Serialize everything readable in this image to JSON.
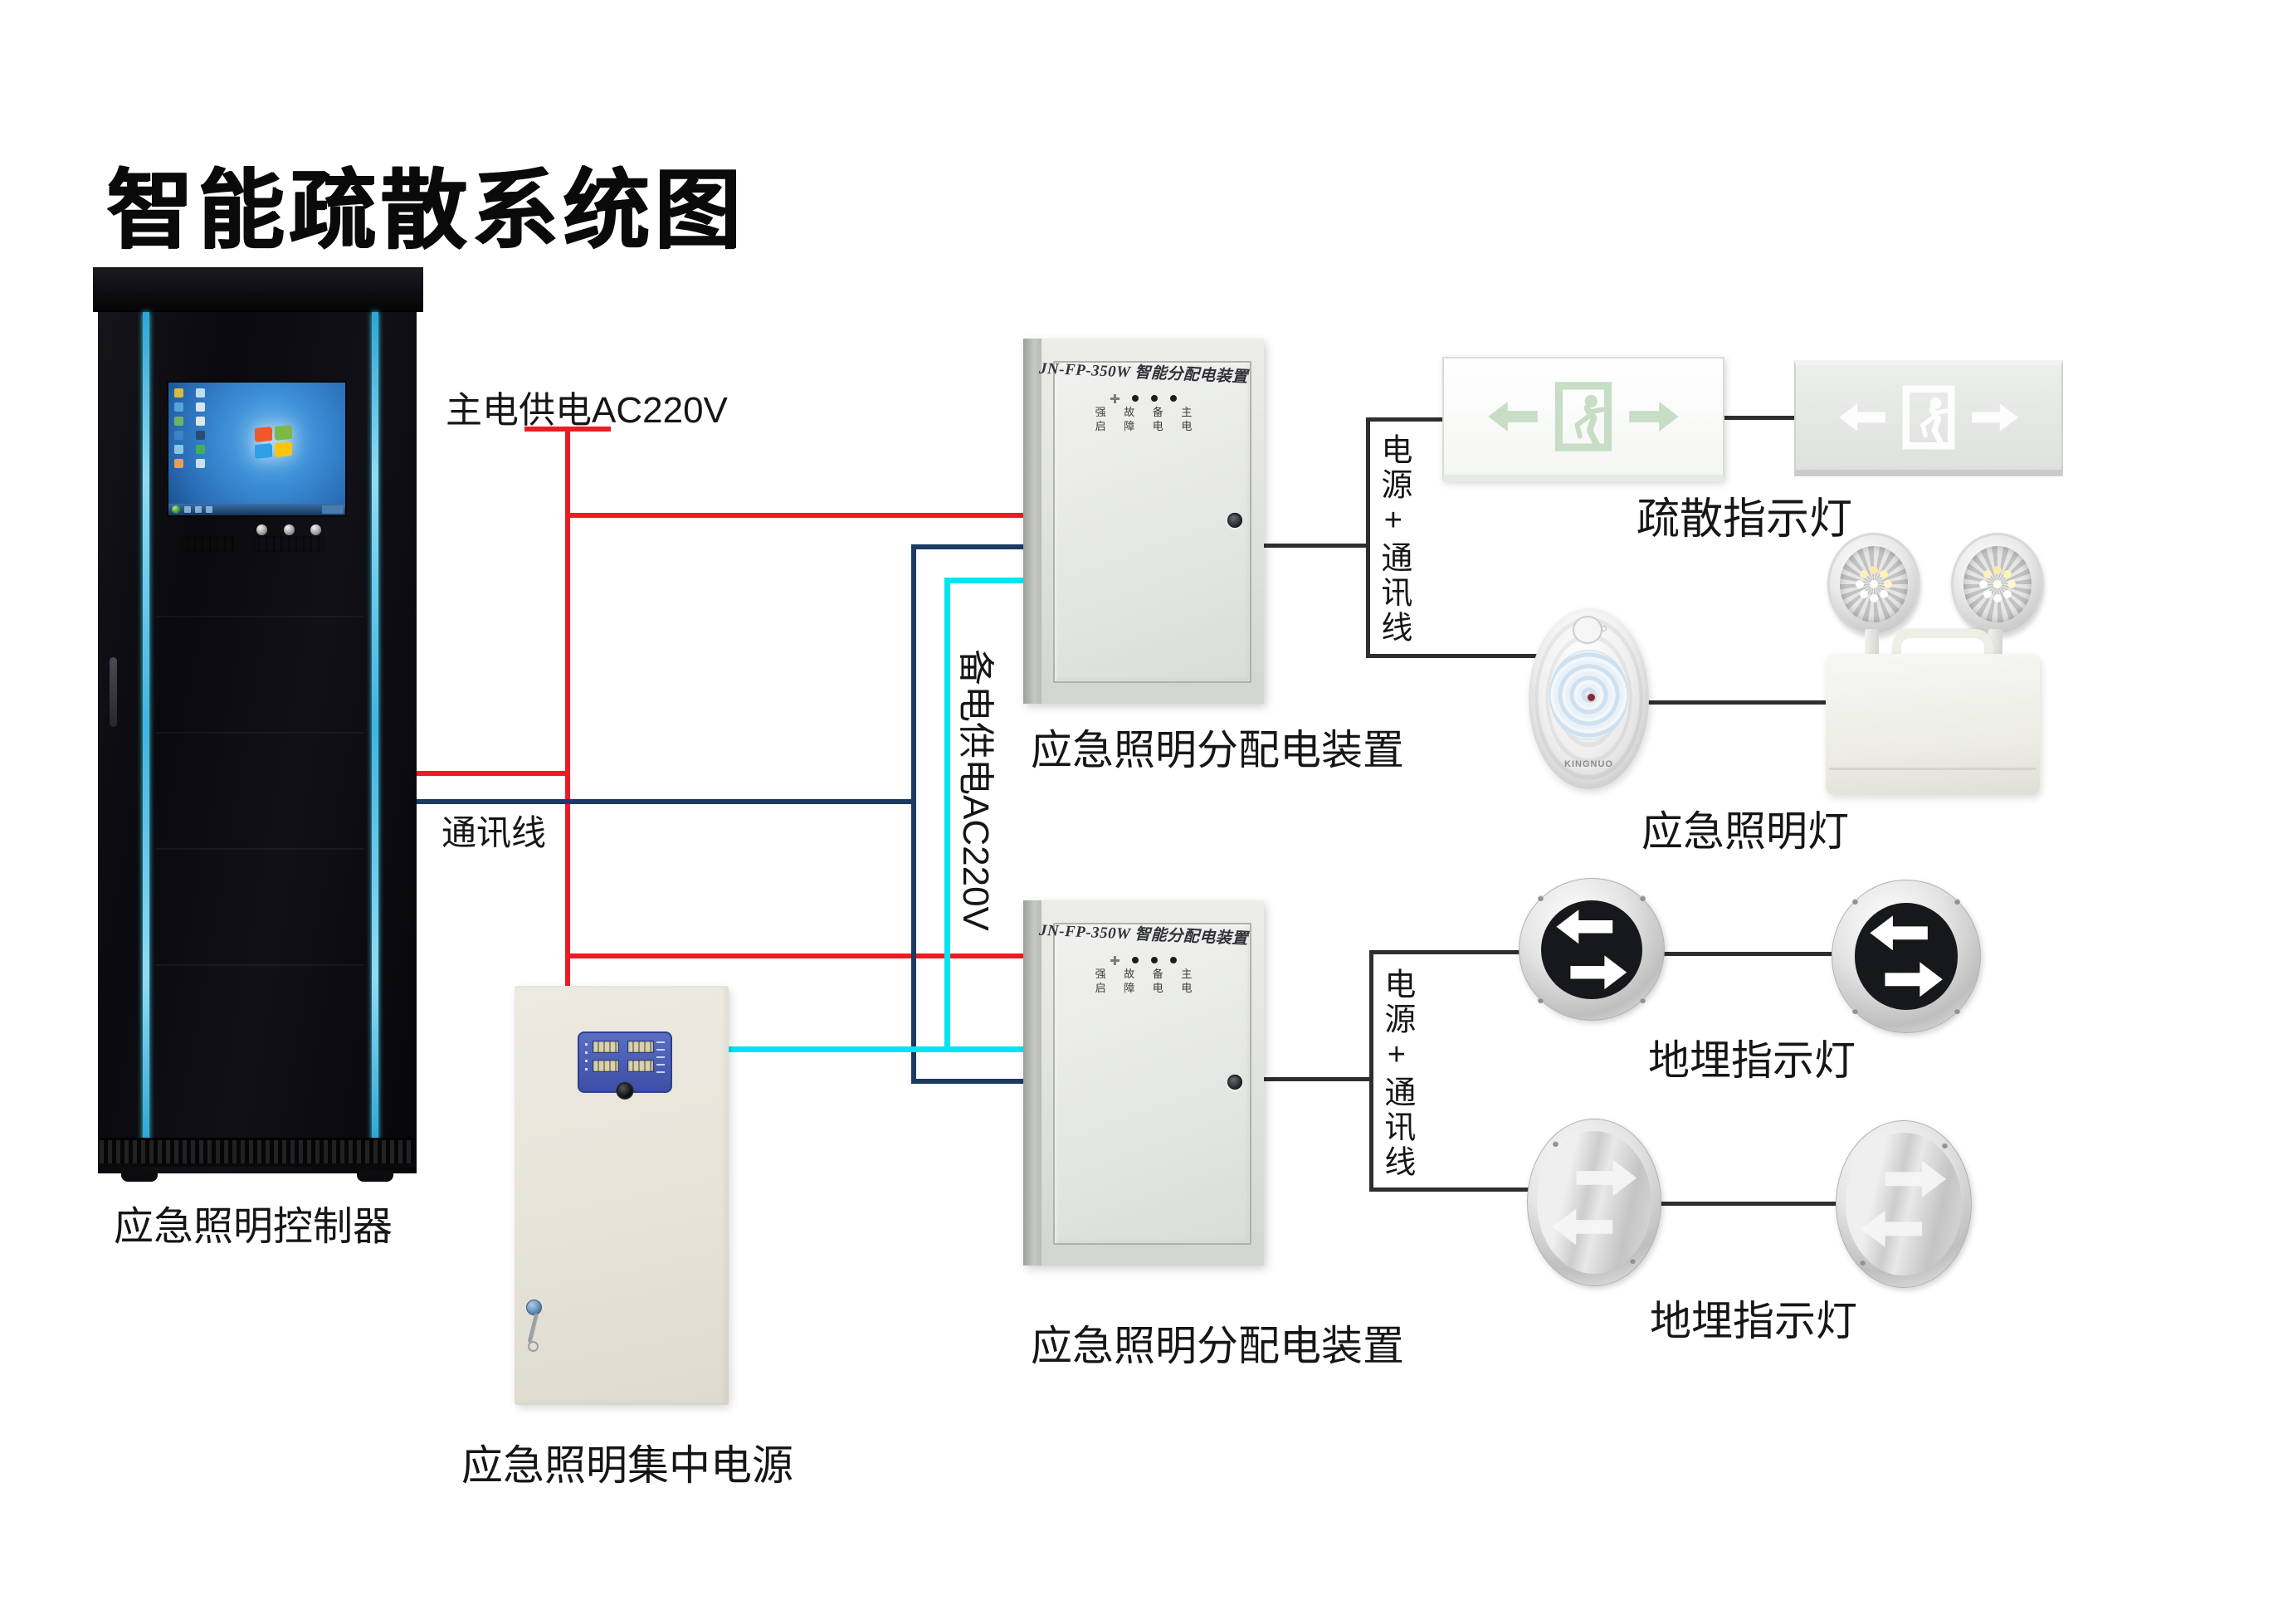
{
  "title": "智能疏散系统图",
  "labels": {
    "controller": "应急照明控制器",
    "central_power": "应急照明集中电源",
    "dist_box_1": "应急照明分配电装置",
    "dist_box_2": "应急照明分配电装置",
    "exit_sign": "疏散指示灯",
    "emergency_light": "应急照明灯",
    "ground_light_1": "地埋指示灯",
    "ground_light_2": "地埋指示灯"
  },
  "wires": {
    "main_power": {
      "label": "主电供电AC220V",
      "color": "#ec1c24"
    },
    "comm": {
      "label": "通讯线",
      "color": "#1b3a64"
    },
    "backup_power": {
      "label": "备电供电AC220V",
      "color": "#00e4f4"
    },
    "power_comm_1": {
      "label": "电源+通讯线",
      "color": "#2e2e2e"
    },
    "power_comm_2": {
      "label": "电源+通讯线",
      "color": "#2e2e2e"
    }
  },
  "dist_box": {
    "model_title": "JN-FP-350W 智能分配电装置",
    "indicator_row_1": "强 故 备 主",
    "indicator_row_2": "启 障 电 电"
  },
  "devices": {
    "lamp_brand": "KINGNUO"
  },
  "connections": [
    {
      "wire": "主电供电AC220V",
      "color": "#ec1c24",
      "connects": [
        "应急照明控制器",
        "应急照明分配电装置(上)",
        "应急照明分配电装置(下)",
        "应急照明集中电源"
      ]
    },
    {
      "wire": "通讯线",
      "color": "#1b3a64",
      "from": "应急照明控制器",
      "to": [
        "应急照明分配电装置(上)",
        "应急照明分配电装置(下)"
      ]
    },
    {
      "wire": "备电供电AC220V",
      "color": "#00e4f4",
      "from": "应急照明集中电源",
      "to": [
        "应急照明分配电装置(上)",
        "应急照明分配电装置(下)"
      ]
    },
    {
      "wire": "电源+通讯线",
      "color": "#2e2e2e",
      "from": "应急照明分配电装置(上)",
      "to": [
        "疏散指示灯",
        "应急照明灯"
      ]
    },
    {
      "wire": "电源+通讯线",
      "color": "#2e2e2e",
      "from": "应急照明分配电装置(下)",
      "to": [
        "地埋指示灯",
        "地埋指示灯"
      ]
    }
  ]
}
